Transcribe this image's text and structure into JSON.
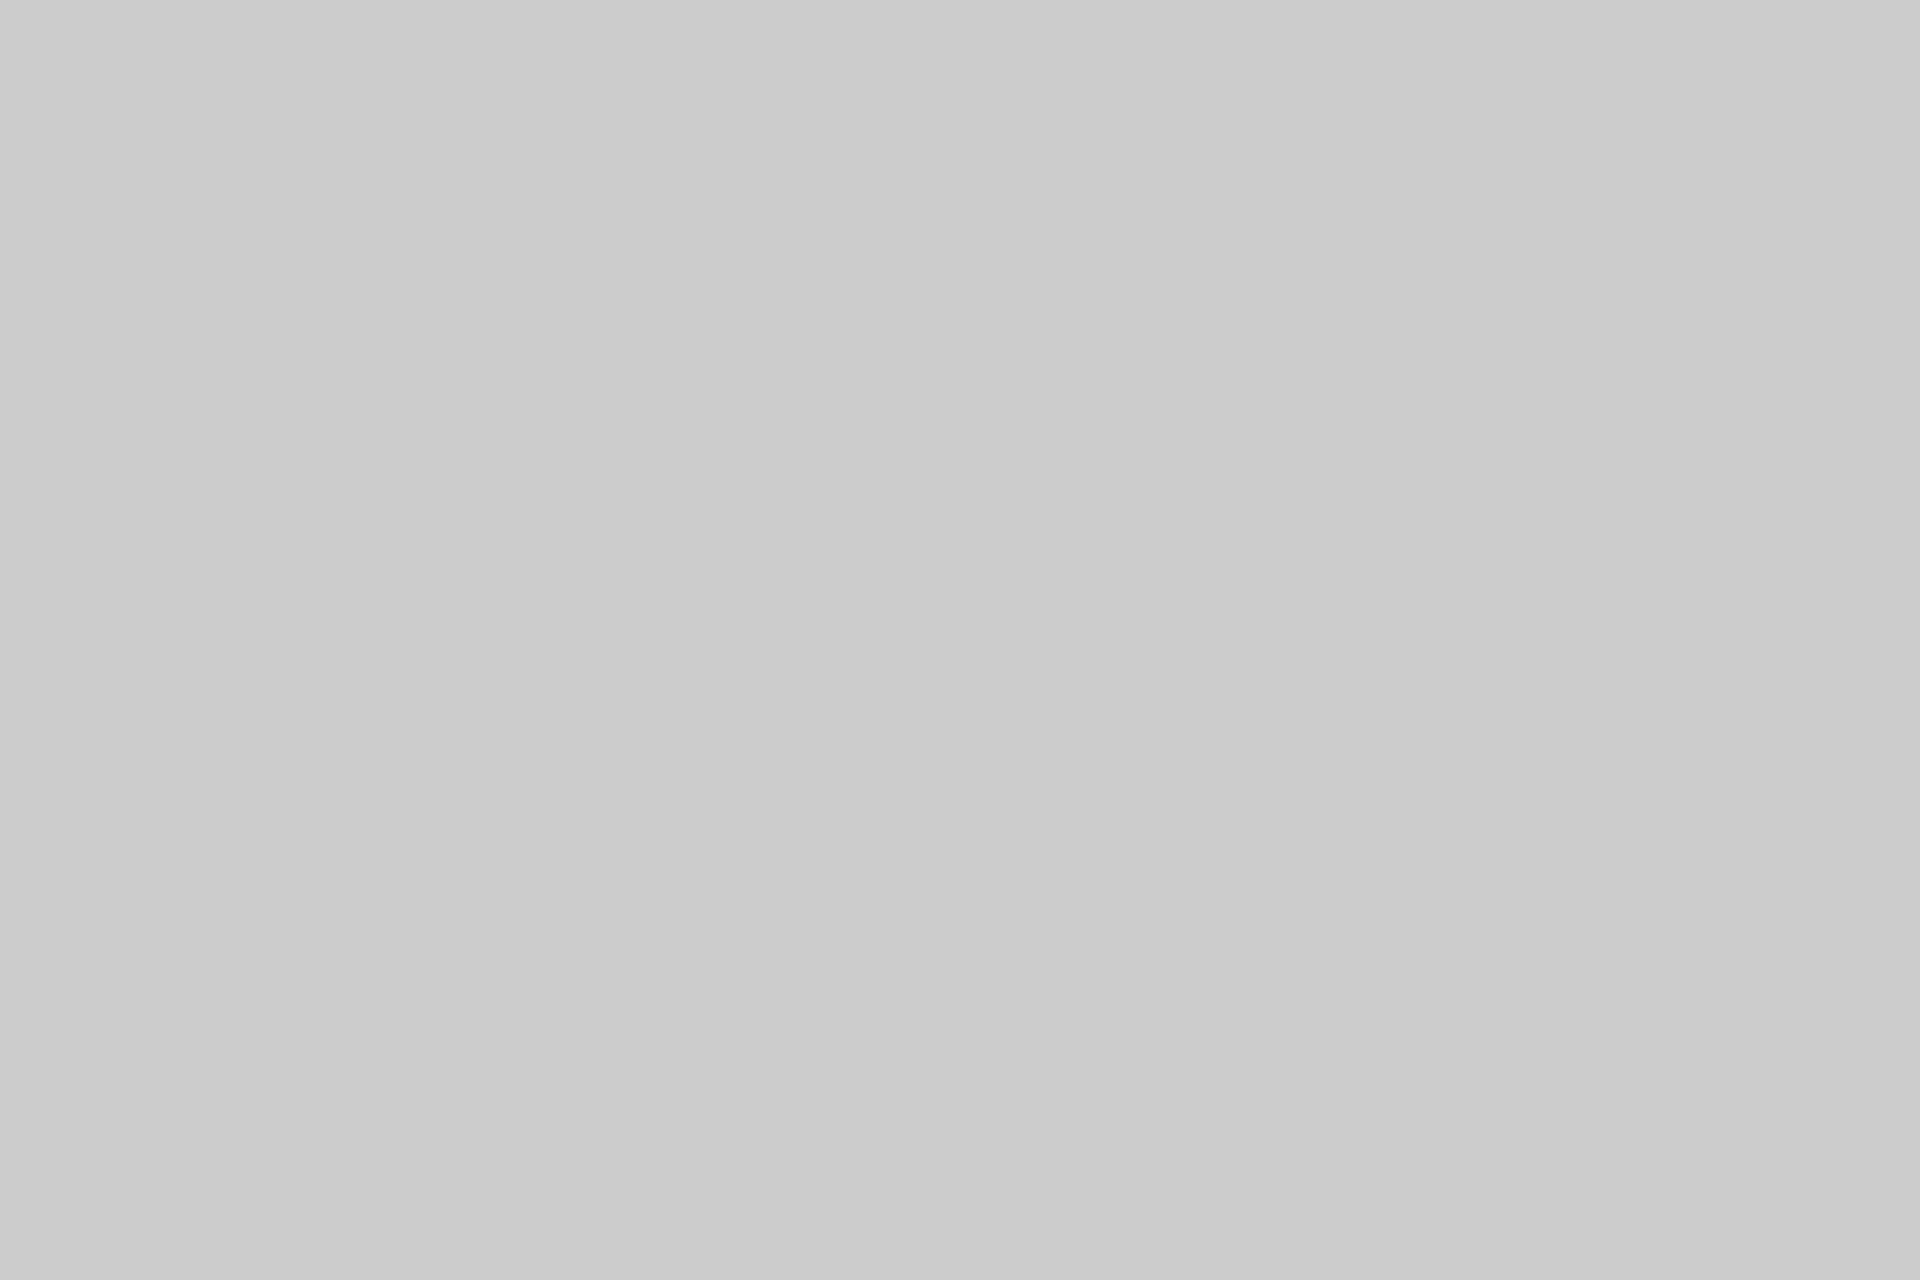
{
  "canvas": {
    "background_color": "#cccccc"
  }
}
